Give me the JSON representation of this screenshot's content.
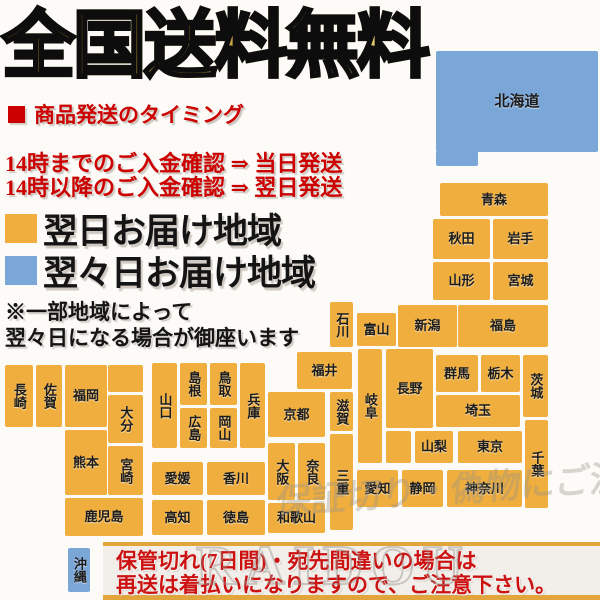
{
  "title": "全国送料無料",
  "shipping_timing": {
    "heading": "商品発送のタイミング",
    "line1": "14時までのご入金確認 ⇒ 当日発送",
    "line2": "14時以降のご入金確認 ⇒ 翌日発送"
  },
  "legend": [
    {
      "label": "翌日お届け地域",
      "key": "next_day"
    },
    {
      "label": "翌々日お届け地域",
      "key": "second_day"
    }
  ],
  "note": {
    "line1": "※一部地域によって",
    "line2": "翌々日になる場合が御座います"
  },
  "colors": {
    "next_day": "#efae3d",
    "second_day": "#7ba7d8",
    "red": "#cc0000",
    "gold_border": "#e2a53c",
    "banner_bg": "#f2efeb"
  },
  "watermark": {
    "caption": "保証切り・偽物にご注意下さい",
    "brand": "RAIDOU"
  },
  "footer": {
    "line1": "保管切れ(7日間)・宛先間違いの場合は",
    "line2": "再送は着払いになりますので、ご注意下さい。"
  },
  "map": {
    "regions": [
      {
        "id": "hokkaido",
        "label": "北海道",
        "delivery": "second_day",
        "x": 436,
        "y": 51,
        "w": 162,
        "h": 101,
        "v": false,
        "big": true
      },
      {
        "id": "hokkaido-ext",
        "label": "",
        "delivery": "second_day",
        "x": 436,
        "y": 151,
        "w": 42,
        "h": 15,
        "v": false
      },
      {
        "id": "aomori",
        "label": "青森",
        "delivery": "next_day",
        "x": 440,
        "y": 183,
        "w": 108,
        "h": 33,
        "v": false
      },
      {
        "id": "akita",
        "label": "秋田",
        "delivery": "next_day",
        "x": 433,
        "y": 219,
        "w": 57,
        "h": 40,
        "v": false
      },
      {
        "id": "iwate",
        "label": "岩手",
        "delivery": "next_day",
        "x": 493,
        "y": 219,
        "w": 55,
        "h": 40,
        "v": false
      },
      {
        "id": "yamagata",
        "label": "山形",
        "delivery": "next_day",
        "x": 433,
        "y": 262,
        "w": 57,
        "h": 38,
        "v": false
      },
      {
        "id": "miyagi",
        "label": "宮城",
        "delivery": "next_day",
        "x": 493,
        "y": 262,
        "w": 55,
        "h": 38,
        "v": false
      },
      {
        "id": "niigata",
        "label": "新潟",
        "delivery": "next_day",
        "x": 398,
        "y": 305,
        "w": 59,
        "h": 42,
        "v": false
      },
      {
        "id": "fukushima",
        "label": "福島",
        "delivery": "next_day",
        "x": 458,
        "y": 305,
        "w": 90,
        "h": 42,
        "v": false
      },
      {
        "id": "ishikawa",
        "label": "石川",
        "delivery": "next_day",
        "x": 330,
        "y": 302,
        "w": 23,
        "h": 45,
        "v": true
      },
      {
        "id": "toyama",
        "label": "富山",
        "delivery": "next_day",
        "x": 357,
        "y": 313,
        "w": 39,
        "h": 33,
        "v": false
      },
      {
        "id": "fukui",
        "label": "福井",
        "delivery": "next_day",
        "x": 297,
        "y": 352,
        "w": 55,
        "h": 37,
        "v": false
      },
      {
        "id": "kyoto",
        "label": "京都",
        "delivery": "next_day",
        "x": 268,
        "y": 392,
        "w": 57,
        "h": 45,
        "v": false
      },
      {
        "id": "shiga",
        "label": "滋賀",
        "delivery": "next_day",
        "x": 330,
        "y": 392,
        "w": 23,
        "h": 39,
        "v": true
      },
      {
        "id": "gifu",
        "label": "岐阜",
        "delivery": "next_day",
        "x": 358,
        "y": 349,
        "w": 24,
        "h": 114,
        "v": true
      },
      {
        "id": "nagano",
        "label": "長野",
        "delivery": "next_day",
        "x": 386,
        "y": 349,
        "w": 47,
        "h": 79,
        "v": false
      },
      {
        "id": "nagano-ext",
        "label": "",
        "delivery": "next_day",
        "x": 386,
        "y": 431,
        "w": 25,
        "h": 32,
        "v": false
      },
      {
        "id": "gunma",
        "label": "群馬",
        "delivery": "next_day",
        "x": 436,
        "y": 355,
        "w": 42,
        "h": 37,
        "v": false
      },
      {
        "id": "tochigi",
        "label": "栃木",
        "delivery": "next_day",
        "x": 481,
        "y": 355,
        "w": 39,
        "h": 37,
        "v": false
      },
      {
        "id": "ibaraki",
        "label": "茨城",
        "delivery": "next_day",
        "x": 523,
        "y": 355,
        "w": 25,
        "h": 62,
        "v": true
      },
      {
        "id": "saitama",
        "label": "埼玉",
        "delivery": "next_day",
        "x": 436,
        "y": 395,
        "w": 84,
        "h": 32,
        "v": false
      },
      {
        "id": "yamanashi",
        "label": "山梨",
        "delivery": "next_day",
        "x": 415,
        "y": 431,
        "w": 38,
        "h": 32,
        "v": false
      },
      {
        "id": "tokyo",
        "label": "東京",
        "delivery": "next_day",
        "x": 458,
        "y": 431,
        "w": 64,
        "h": 32,
        "v": false
      },
      {
        "id": "chiba",
        "label": "千葉",
        "delivery": "next_day",
        "x": 525,
        "y": 420,
        "w": 23,
        "h": 88,
        "v": true
      },
      {
        "id": "kanagawa",
        "label": "神奈川",
        "delivery": "next_day",
        "x": 447,
        "y": 470,
        "w": 75,
        "h": 37,
        "v": false
      },
      {
        "id": "shizuoka",
        "label": "静岡",
        "delivery": "next_day",
        "x": 402,
        "y": 470,
        "w": 41,
        "h": 37,
        "v": false
      },
      {
        "id": "aichi",
        "label": "愛知",
        "delivery": "next_day",
        "x": 357,
        "y": 470,
        "w": 41,
        "h": 37,
        "v": false
      },
      {
        "id": "mie",
        "label": "三重",
        "delivery": "next_day",
        "x": 330,
        "y": 434,
        "w": 23,
        "h": 96,
        "v": true
      },
      {
        "id": "osaka",
        "label": "大阪",
        "delivery": "next_day",
        "x": 268,
        "y": 443,
        "w": 27,
        "h": 57,
        "v": true
      },
      {
        "id": "nara",
        "label": "奈良",
        "delivery": "next_day",
        "x": 298,
        "y": 443,
        "w": 27,
        "h": 57,
        "v": true
      },
      {
        "id": "wakayama",
        "label": "和歌山",
        "delivery": "next_day",
        "x": 268,
        "y": 503,
        "w": 57,
        "h": 30,
        "v": false
      },
      {
        "id": "hyogo",
        "label": "兵庫",
        "delivery": "next_day",
        "x": 240,
        "y": 363,
        "w": 25,
        "h": 85,
        "v": true
      },
      {
        "id": "tottori",
        "label": "鳥取",
        "delivery": "next_day",
        "x": 210,
        "y": 363,
        "w": 27,
        "h": 42,
        "v": true
      },
      {
        "id": "shimane",
        "label": "島根",
        "delivery": "next_day",
        "x": 180,
        "y": 363,
        "w": 27,
        "h": 42,
        "v": true
      },
      {
        "id": "okayama",
        "label": "岡山",
        "delivery": "next_day",
        "x": 210,
        "y": 408,
        "w": 27,
        "h": 40,
        "v": true
      },
      {
        "id": "hiroshima",
        "label": "広島",
        "delivery": "next_day",
        "x": 180,
        "y": 408,
        "w": 27,
        "h": 40,
        "v": true
      },
      {
        "id": "yamaguchi",
        "label": "山口",
        "delivery": "next_day",
        "x": 152,
        "y": 363,
        "w": 25,
        "h": 85,
        "v": true
      },
      {
        "id": "ehime",
        "label": "愛媛",
        "delivery": "next_day",
        "x": 152,
        "y": 462,
        "w": 51,
        "h": 33,
        "v": false
      },
      {
        "id": "kagawa",
        "label": "香川",
        "delivery": "next_day",
        "x": 207,
        "y": 462,
        "w": 58,
        "h": 33,
        "v": false
      },
      {
        "id": "kochi",
        "label": "高知",
        "delivery": "next_day",
        "x": 152,
        "y": 500,
        "w": 51,
        "h": 35,
        "v": false
      },
      {
        "id": "tokushima",
        "label": "徳島",
        "delivery": "next_day",
        "x": 207,
        "y": 500,
        "w": 58,
        "h": 35,
        "v": false
      },
      {
        "id": "nagasaki",
        "label": "長崎",
        "delivery": "next_day",
        "x": 5,
        "y": 365,
        "w": 28,
        "h": 62,
        "v": true
      },
      {
        "id": "saga",
        "label": "佐賀",
        "delivery": "next_day",
        "x": 36,
        "y": 365,
        "w": 26,
        "h": 62,
        "v": true
      },
      {
        "id": "fukuoka",
        "label": "福岡",
        "delivery": "next_day",
        "x": 65,
        "y": 365,
        "w": 42,
        "h": 62,
        "v": false
      },
      {
        "id": "fukuoka-ext",
        "label": "",
        "delivery": "next_day",
        "x": 108,
        "y": 365,
        "w": 35,
        "h": 27,
        "v": false
      },
      {
        "id": "oita",
        "label": "大分",
        "delivery": "next_day",
        "x": 108,
        "y": 395,
        "w": 35,
        "h": 48,
        "v": true
      },
      {
        "id": "kumamoto",
        "label": "熊本",
        "delivery": "next_day",
        "x": 65,
        "y": 430,
        "w": 42,
        "h": 65,
        "v": false
      },
      {
        "id": "miyazaki",
        "label": "宮崎",
        "delivery": "next_day",
        "x": 108,
        "y": 446,
        "w": 35,
        "h": 49,
        "v": true
      },
      {
        "id": "kagoshima",
        "label": "鹿児島",
        "delivery": "next_day",
        "x": 65,
        "y": 498,
        "w": 78,
        "h": 38,
        "v": false
      },
      {
        "id": "okinawa",
        "label": "沖縄",
        "delivery": "second_day",
        "x": 68,
        "y": 548,
        "w": 22,
        "h": 44,
        "v": true
      }
    ]
  }
}
